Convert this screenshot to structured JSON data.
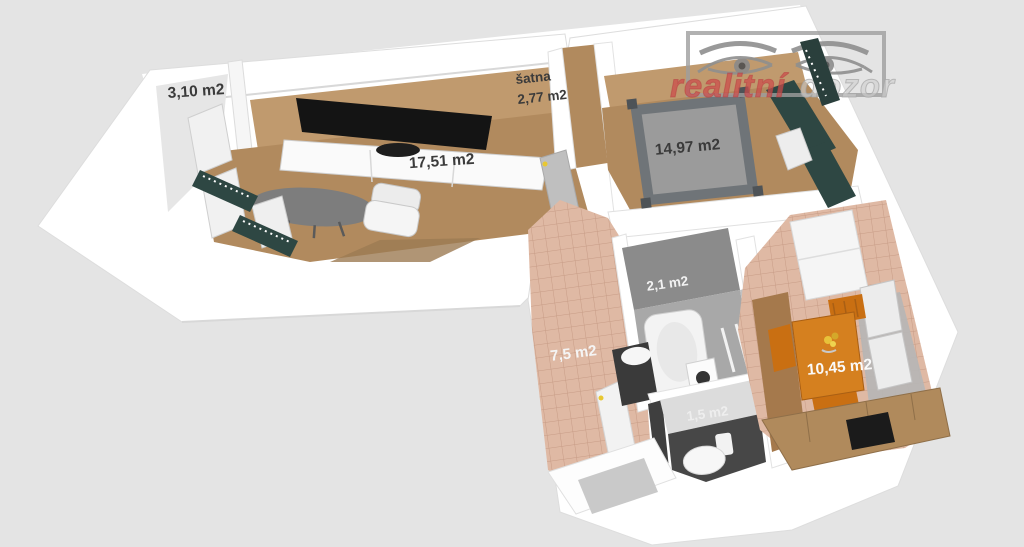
{
  "title": "3D floor plan render",
  "watermark": {
    "word_red": "realitní",
    "word_gray": "dozor"
  },
  "rooms": {
    "balcony": {
      "area": "3,10 m2"
    },
    "living_room": {
      "area": "17,51 m2"
    },
    "closet": {
      "name": "šatna",
      "area": "2,77 m2"
    },
    "bedroom": {
      "area": "14,97 m2"
    },
    "bathroom": {
      "area": "2,1 m2"
    },
    "hallway": {
      "area": "7,5 m2"
    },
    "wc": {
      "area": "1,5 m2"
    },
    "kitchen": {
      "area": "10,45 m2"
    }
  },
  "colors": {
    "background": "#e4e4e4",
    "wall_white": "#ffffff",
    "wood_floor": "#b18a5e",
    "wall_inner_tan": "#c09a6e",
    "tile_floor": "#dfb9a4",
    "tile_line": "#c79c86",
    "bathroom_gray": "#a8a8a8",
    "bathroom_wall_gray": "#8b8b8b",
    "dark_tile": "#474747",
    "furniture_green": "#2e4743",
    "table_orange": "#d5801f",
    "chair_orange": "#c96f12",
    "bed_gray": "#9b9b9b",
    "bed_frame_gray": "#6f7478",
    "counter_wood": "#b08a5c",
    "label_dark": "#3b3b3b",
    "label_light": "#f5f5f5",
    "handle_yellow": "#e8c832",
    "brand_red": "#cc4b4b",
    "brand_gray": "#cfcfcf",
    "logo_gray": "#8f8f8f"
  }
}
